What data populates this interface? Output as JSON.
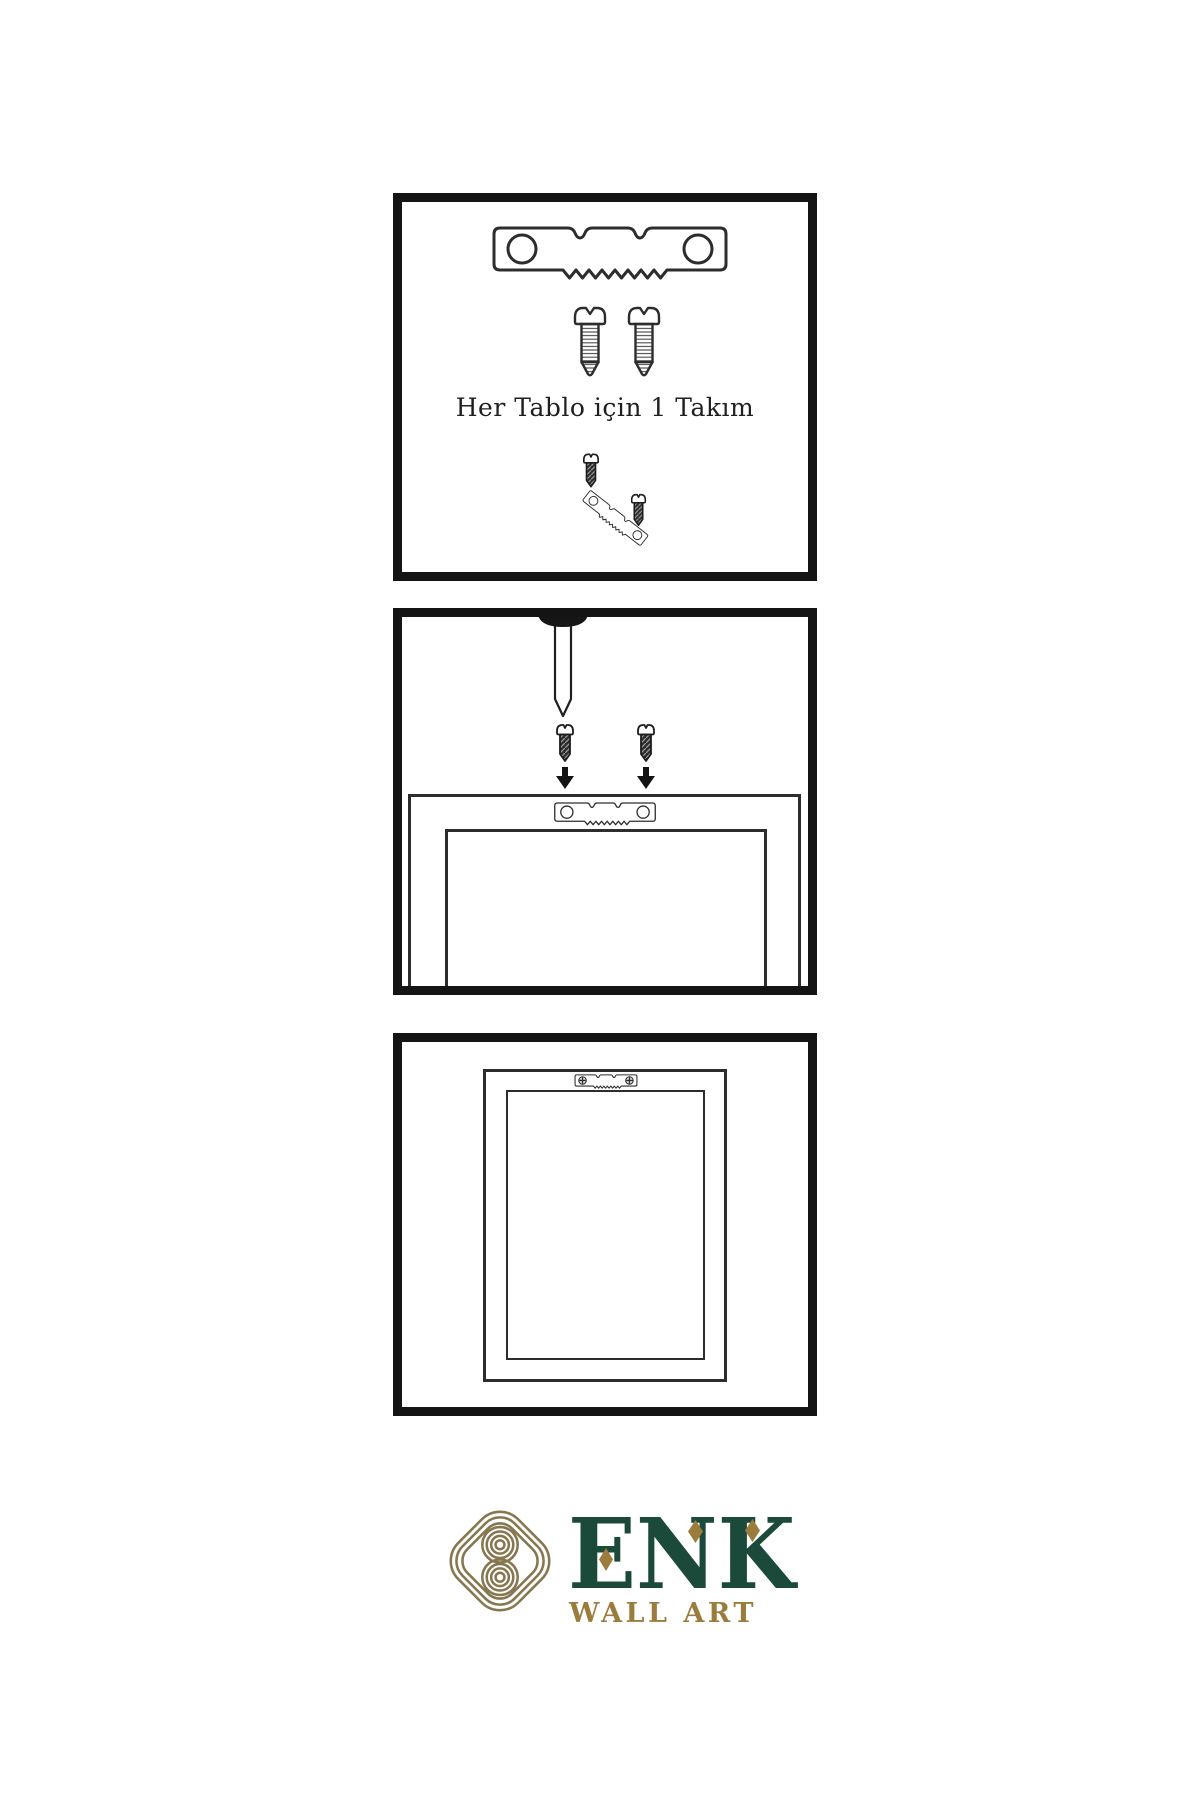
{
  "sheet": {
    "background": "#ffffff",
    "panel_border_color": "#141414",
    "line_color": "#2d2d2d",
    "dark_fill": "#2c2c2c"
  },
  "panels": [
    {
      "id": "hardware-kit",
      "caption": "Her Tablo için 1 Takım",
      "contents": [
        "sawtooth-hanger",
        "screw",
        "screw",
        "screw-driving-into-tilted-sawtooth-hanger"
      ]
    },
    {
      "id": "mounting-step",
      "contents": [
        "nail-in-wall",
        "screw-with-down-arrow",
        "screw-with-down-arrow",
        "frame-back-with-sawtooth-hanger"
      ]
    },
    {
      "id": "hung-frame",
      "contents": [
        "frame-back",
        "mounted-sawtooth-hanger-with-phillips-screws"
      ]
    }
  ],
  "logo": {
    "brand": "ENK",
    "subtitle": "WALL ART",
    "brand_color": "#1c4a3a",
    "gold_color": "#9a7c3d",
    "knot_color": "#877750"
  }
}
